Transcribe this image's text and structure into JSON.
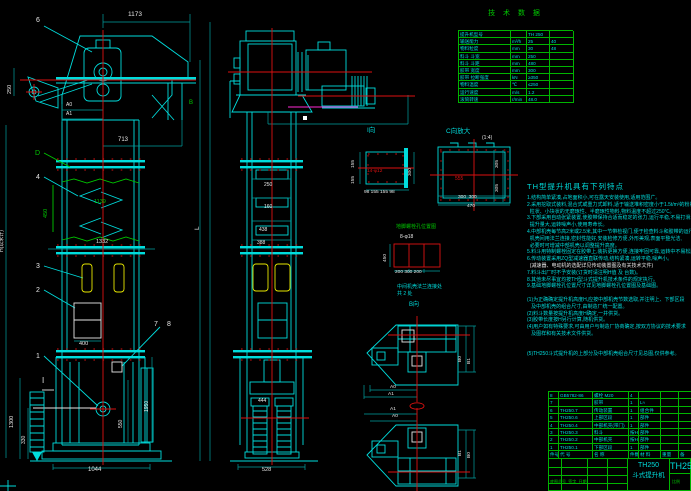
{
  "colors": {
    "cyan": "#00dcdc",
    "green": "#00c800",
    "red": "#dd1111",
    "yellow": "#e6e600",
    "white": "#e6e6e6",
    "magenta": "#ff2ad4",
    "grid_green": "#00b400"
  },
  "tech": {
    "title": "技 术 数 据",
    "widths": [
      52,
      16,
      23,
      24
    ],
    "rows": [
      [
        "提升机型号",
        "",
        "TH 250",
        ""
      ],
      [
        "输送能力",
        "m³/h",
        "25",
        "40"
      ],
      [
        "物料粒度",
        "mm",
        "30",
        "48"
      ],
      [
        "料斗 斗宽",
        "mm",
        "250",
        ""
      ],
      [
        "料斗 斗距",
        "mm",
        "480",
        ""
      ],
      [
        "胶带 宽度",
        "mm",
        "300",
        ""
      ],
      [
        "胶带 拉断强度",
        "kN",
        "≥350",
        ""
      ],
      [
        "物料温度",
        "℃",
        "≤250",
        ""
      ],
      [
        "运行速度",
        "m/s",
        "1.2",
        ""
      ],
      [
        "滚筒转速",
        "r/min",
        "48.0",
        ""
      ]
    ]
  },
  "features": {
    "title": "TH型提升机具有下列特点",
    "lines": [
      "1.结构简单紧凑,占地面积小,可在露天安装使用,适用范围广。",
      "2.采用挖取式装料,混合式或重力式卸料,适于输送堆积密度小于1.5t/m³的粉状、",
      "  粒状、小块状的无磨琢性、半磨琢性物料,物料温度不超过250℃。",
      "3.下部采用自动张紧装置,使胶带保持合适而稳定的张力,运行平稳,不易打滑,",
      "  提升量大,运转噪声小,使用寿命长。",
      "4.中部机壳每节高2米或2.5米,其中一节带检视门,便于检查料斗和胶带的运行,",
      "  机壳间用法兰连接,密封性能好,安装检修方便,外形美观,表面平整光洁,",
      "  必要时可增减中部机壳以调整提升高度。",
      "5.料斗用特制螺栓固定在胶带上,装拆更换方便,连接牢固可靠,运转中不易松脱。",
      "6.传动装置采用ZQ型减速器直联传动,结构紧凑,运转平稳,噪声小。",
      {
        "t": "  (减速器、电动机的选配详见传动装置图及有关技术文件)",
        "c": "#e6e6e6"
      },
      "7.料斗出厂时不予安装(订货时请注明H值 及 台数)。",
      "8.其他未尽事宜均按TH型斗式提升机技术条件的规定执行。",
      "9.基础地脚螺栓孔位置尺寸详见地脚螺栓孔位置图及基础图。",
      "",
      "(1)为正确确定提升机高度H,应按中部机壳节数选取,并注明上、下部区段",
      "   及中部机壳的组合尺寸,由制造厂统一配置。",
      "(2)料斗数量按提升机高度H确定,一并供货。",
      "(3)胶带长度按H另行计算,随机供货。",
      "(4)用户如有特殊要求,可由用户与制造厂协商确定,按双方协议的技术要求",
      "   及图样和有关技术文件供货。",
      "",
      "",
      "(5)TH250斗式提升机的上部分及中部机壳组合尺寸见总图,仅供参考。"
    ]
  },
  "bom": {
    "widths": [
      10,
      34,
      36,
      10,
      22,
      18,
      13
    ],
    "rows": [
      [
        "8",
        "GB5782-86",
        "螺栓 M20",
        "4",
        "",
        "",
        ""
      ],
      [
        "7",
        "",
        "胶带",
        "1",
        "L≈",
        "",
        ""
      ],
      [
        "6",
        "TH250.7",
        "传动装置",
        "1",
        "组合件",
        "",
        ""
      ],
      [
        "5",
        "TH250.6",
        "上部区段",
        "1",
        "部件",
        "",
        ""
      ],
      [
        "4",
        "TH250.4",
        "中部机壳(带门)",
        "1",
        "部件",
        "",
        ""
      ],
      [
        "3",
        "TH250.3",
        "料斗",
        "按H",
        "部件",
        "",
        ""
      ],
      [
        "2",
        "TH250.2",
        "中部机壳",
        "按H",
        "部件",
        "",
        ""
      ],
      [
        "1",
        "TH250.1",
        "下部区段",
        "1",
        "部件",
        "",
        ""
      ],
      [
        "件号",
        "代  号",
        "名  称",
        "件数",
        "材 料",
        "重量",
        "备"
      ]
    ]
  },
  "title_block": {
    "model": "TH250",
    "name": "斗式提升机",
    "model_right": "TH250"
  },
  "annotations": [
    {
      "n": "dim-1173",
      "t": "1173",
      "x": 128,
      "y": 12,
      "c": "#e6e6e6",
      "s": 6.5
    },
    {
      "n": "label-6",
      "t": "6",
      "x": 36,
      "y": 17,
      "c": "#e6e6e6",
      "s": 7
    },
    {
      "n": "dim-250-left",
      "t": "250",
      "x": 8,
      "y": 94,
      "c": "#e6e6e6",
      "s": 5.5,
      "r": 1
    },
    {
      "n": "label-B",
      "t": "B",
      "x": 189,
      "y": 100,
      "c": "#00c800",
      "s": 6
    },
    {
      "n": "dim-A0",
      "t": "A0",
      "x": 66,
      "y": 103,
      "c": "#e6e6e6",
      "s": 5
    },
    {
      "n": "dim-A1",
      "t": "A1",
      "x": 66,
      "y": 112,
      "c": "#e6e6e6",
      "s": 5
    },
    {
      "n": "dim-713",
      "t": "713",
      "x": 118,
      "y": 137,
      "c": "#e6e6e6",
      "s": 6
    },
    {
      "n": "label-D",
      "t": "D",
      "x": 35,
      "y": 150,
      "c": "#00c800",
      "s": 7
    },
    {
      "n": "label-4",
      "t": "4",
      "x": 36,
      "y": 174,
      "c": "#e6e6e6",
      "s": 7
    },
    {
      "n": "dim-450",
      "t": "450",
      "x": 44,
      "y": 218,
      "c": "#00c800",
      "s": 5.5,
      "r": 1
    },
    {
      "n": "dim-1139",
      "t": "1139",
      "x": 94,
      "y": 200,
      "c": "#00c800",
      "s": 5.5
    },
    {
      "n": "dim-1332",
      "t": "1332",
      "x": 96,
      "y": 240,
      "c": "#e6e6e6",
      "s": 5.5
    },
    {
      "n": "label-3",
      "t": "3",
      "x": 36,
      "y": 263,
      "c": "#e6e6e6",
      "s": 7
    },
    {
      "n": "label-2",
      "t": "2",
      "x": 36,
      "y": 287,
      "c": "#e6e6e6",
      "s": 7
    },
    {
      "n": "dim-400",
      "t": "400",
      "x": 79,
      "y": 342,
      "c": "#e6e6e6",
      "s": 5.5
    },
    {
      "n": "label-7",
      "t": "7",
      "x": 154,
      "y": 321,
      "c": "#e6e6e6",
      "s": 7
    },
    {
      "n": "label-8",
      "t": "8",
      "x": 167,
      "y": 321,
      "c": "#e6e6e6",
      "s": 7
    },
    {
      "n": "label-1",
      "t": "1",
      "x": 36,
      "y": 353,
      "c": "#e6e6e6",
      "s": 7
    },
    {
      "n": "section-I-mark",
      "t": "I",
      "x": 42,
      "y": 377,
      "c": "#e6e6e6",
      "s": 8
    },
    {
      "n": "dim-1300",
      "t": "1300",
      "x": 10,
      "y": 428,
      "c": "#e6e6e6",
      "s": 5.5,
      "r": 1
    },
    {
      "n": "dim-330",
      "t": "330",
      "x": 22,
      "y": 444,
      "c": "#e6e6e6",
      "s": 5,
      "r": 1
    },
    {
      "n": "dim-550",
      "t": "550",
      "x": 119,
      "y": 428,
      "c": "#e6e6e6",
      "s": 5,
      "r": 1
    },
    {
      "n": "dim-1950",
      "t": "1950",
      "x": 145,
      "y": 412,
      "c": "#e6e6e6",
      "s": 5,
      "r": 1
    },
    {
      "n": "dim-1044",
      "t": "1044",
      "x": 88,
      "y": 467,
      "c": "#e6e6e6",
      "s": 6
    },
    {
      "n": "dim-L",
      "t": "L",
      "x": 195,
      "y": 230,
      "c": "#e6e6e6",
      "s": 6.5,
      "r": 1
    },
    {
      "n": "dim-H-total",
      "t": "H(以米计)",
      "x": 0,
      "y": 252,
      "c": "#e6e6e6",
      "s": 5,
      "r": 1
    },
    {
      "n": "dim-250-side",
      "t": "250",
      "x": 264,
      "y": 183,
      "c": "#e6e6e6",
      "s": 5
    },
    {
      "n": "dim-160",
      "t": "160",
      "x": 264,
      "y": 205,
      "c": "#e6e6e6",
      "s": 5
    },
    {
      "n": "dim-438",
      "t": "438",
      "x": 259,
      "y": 228,
      "c": "#e6e6e6",
      "s": 5
    },
    {
      "n": "dim-388",
      "t": "388",
      "x": 257,
      "y": 241,
      "c": "#e6e6e6",
      "s": 5
    },
    {
      "n": "dim-444",
      "t": "444",
      "x": 258,
      "y": 399,
      "c": "#e6e6e6",
      "s": 5
    },
    {
      "n": "dim-528",
      "t": "528",
      "x": 262,
      "y": 468,
      "c": "#e6e6e6",
      "s": 5.5
    },
    {
      "n": "view-I-label",
      "t": "I向",
      "x": 367,
      "y": 128,
      "c": "#00dcdc",
      "s": 6.5
    },
    {
      "n": "si-bolt-note",
      "t": "14-φ12",
      "x": 367,
      "y": 170,
      "c": "#dd1111",
      "s": 4.8
    },
    {
      "n": "si-155a",
      "t": "155",
      "x": 352,
      "y": 168,
      "c": "#e6e6e6",
      "s": 4.8,
      "r": 1
    },
    {
      "n": "si-155b",
      "t": "155",
      "x": 352,
      "y": 184,
      "c": "#e6e6e6",
      "s": 4.8,
      "r": 1
    },
    {
      "n": "si-300",
      "t": "300",
      "x": 409,
      "y": 176,
      "c": "#e6e6e6",
      "s": 4.8,
      "r": 1
    },
    {
      "n": "si-bottom-dims",
      "t": "98 155 155 98",
      "x": 364,
      "y": 191,
      "c": "#e6e6e6",
      "s": 4.8
    },
    {
      "n": "view-C-label",
      "t": "C向放大",
      "x": 446,
      "y": 129,
      "c": "#00dcdc",
      "s": 6.5
    },
    {
      "n": "view-C-scale",
      "t": "(1:4)",
      "x": 482,
      "y": 136,
      "c": "#e6e6e6",
      "s": 5
    },
    {
      "n": "sc-555",
      "t": "555",
      "x": 455,
      "y": 177,
      "c": "#dd1111",
      "s": 5
    },
    {
      "n": "sc-305a",
      "t": "305",
      "x": 496,
      "y": 168,
      "c": "#e6e6e6",
      "s": 4.8,
      "r": 1
    },
    {
      "n": "sc-305b",
      "t": "305",
      "x": 496,
      "y": 192,
      "c": "#e6e6e6",
      "s": 4.8,
      "r": 1
    },
    {
      "n": "sc-bottom-dims",
      "t": "300  300",
      "x": 458,
      "y": 196,
      "c": "#e6e6e6",
      "s": 4.8
    },
    {
      "n": "sc-470",
      "t": "470",
      "x": 467,
      "y": 205,
      "c": "#e6e6e6",
      "s": 4.8
    },
    {
      "n": "anchor-title",
      "t": "地脚螺栓孔位置图",
      "x": 396,
      "y": 225,
      "c": "#00c800",
      "s": 5
    },
    {
      "n": "anchor-bolts",
      "t": "8-φ18",
      "x": 400,
      "y": 235,
      "c": "#e6e6e6",
      "s": 5
    },
    {
      "n": "anchor-450",
      "t": "450",
      "x": 384,
      "y": 262,
      "c": "#e6e6e6",
      "s": 4.8,
      "r": 1
    },
    {
      "n": "anchor-bottom-dims",
      "t": "200 300 200",
      "x": 395,
      "y": 271,
      "c": "#e6e6e6",
      "s": 4.8
    },
    {
      "n": "anchor-note1",
      "t": "中间机壳法兰连接处",
      "x": 397,
      "y": 285,
      "c": "#00dcdc",
      "s": 5
    },
    {
      "n": "anchor-note2",
      "t": "共 2 处",
      "x": 397,
      "y": 292,
      "c": "#00dcdc",
      "s": 5
    },
    {
      "n": "view-B-label",
      "t": "B向",
      "x": 409,
      "y": 302,
      "c": "#00dcdc",
      "s": 6
    },
    {
      "n": "dv1-B0",
      "t": "B0",
      "x": 459,
      "y": 362,
      "c": "#e6e6e6",
      "s": 4.8,
      "r": 1
    },
    {
      "n": "dv1-B1",
      "t": "B1",
      "x": 468,
      "y": 364,
      "c": "#e6e6e6",
      "s": 4.8,
      "r": 1
    },
    {
      "n": "dv1-A0",
      "t": "A0",
      "x": 390,
      "y": 386,
      "c": "#e6e6e6",
      "s": 4.8
    },
    {
      "n": "dv1-A1",
      "t": "A1",
      "x": 388,
      "y": 393,
      "c": "#e6e6e6",
      "s": 4.8
    },
    {
      "n": "dv2-A1",
      "t": "A1",
      "x": 390,
      "y": 408,
      "c": "#e6e6e6",
      "s": 4.8
    },
    {
      "n": "dv2-A0",
      "t": "A0",
      "x": 392,
      "y": 415,
      "c": "#e6e6e6",
      "s": 4.8
    },
    {
      "n": "dv2-B1",
      "t": "B1",
      "x": 459,
      "y": 456,
      "c": "#e6e6e6",
      "s": 4.8,
      "r": 1
    },
    {
      "n": "dv2-B0",
      "t": "B0",
      "x": 468,
      "y": 458,
      "c": "#e6e6e6",
      "s": 4.8,
      "r": 1
    },
    {
      "n": "tb-left-note",
      "t": "底图总号  签字  日期",
      "x": 550,
      "y": 480,
      "c": "#00c800",
      "s": 4
    },
    {
      "n": "tb-scale",
      "t": "比例",
      "x": 672,
      "y": 480,
      "c": "#00c800",
      "s": 4
    }
  ]
}
